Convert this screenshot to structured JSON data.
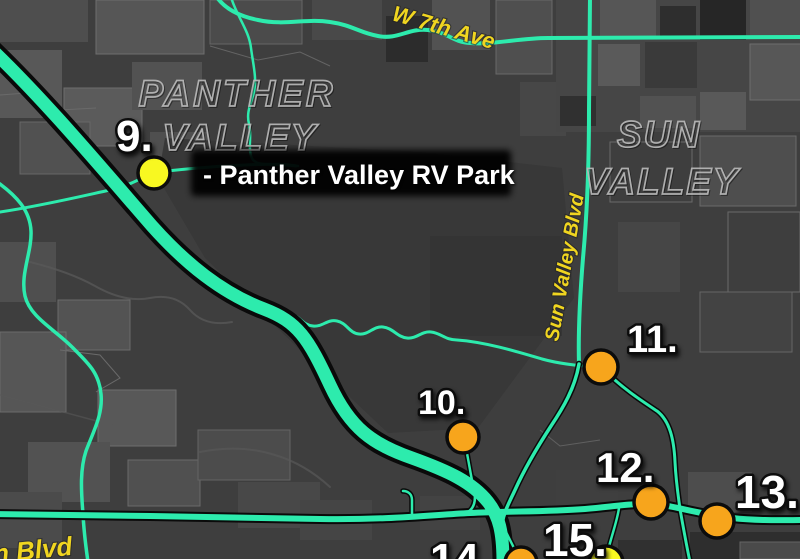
{
  "map": {
    "place_labels": {
      "panther_valley": {
        "line1": "PANTHER",
        "line2": "VALLEY"
      },
      "sun_valley": {
        "line1": "SUN",
        "line2": "VALLEY"
      }
    },
    "street_labels": {
      "w_7th_ave": "W 7th Ave",
      "sun_valley_blvd": "Sun Valley Blvd",
      "n_blvd": "n Blvd"
    },
    "callout": {
      "text": "- Panther Valley RV Park"
    },
    "markers": [
      {
        "number": "9.",
        "type": "yellow"
      },
      {
        "number": "10.",
        "type": "orange"
      },
      {
        "number": "11.",
        "type": "orange"
      },
      {
        "number": "12.",
        "type": "orange"
      },
      {
        "number": "13.",
        "type": "orange"
      },
      {
        "number": "14.",
        "type": "orange"
      },
      {
        "number": "15.",
        "type": "yellow"
      }
    ],
    "colors": {
      "road": "#2debad",
      "street_label": "#f0d520",
      "marker_orange": "#f7a51c",
      "marker_yellow": "#f8f821",
      "background": "#3e3e3e",
      "place_label_stroke": "#b8b8b8",
      "callout_bg": "#050505",
      "number_fill": "#ffffff"
    }
  }
}
